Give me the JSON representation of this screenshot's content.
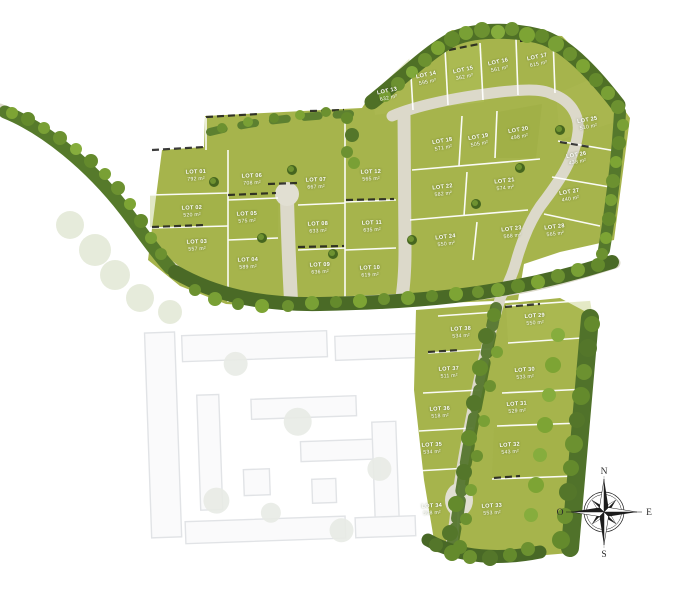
{
  "plan_title": "",
  "area_unit": "m²",
  "compass": {
    "north": "N",
    "south": "S",
    "east": "E",
    "west": "O"
  },
  "colors": {
    "lot_green": "#a6b44c",
    "tree_dark": "#47671f",
    "tree_mid": "#648a2c",
    "tree_light": "#7da434",
    "road": "#dcd9ca",
    "boundary_white": "#ffffff",
    "fence_black": "#1c1c1c",
    "ghost_gray": "#7b8591",
    "compass_ink": "#1d1d1d",
    "background": "#ffffff"
  },
  "lots": [
    {
      "id": "LOT 01",
      "area": "792 m²",
      "x": 196,
      "y": 176,
      "rot": -2
    },
    {
      "id": "LOT 02",
      "area": "520 m²",
      "x": 192,
      "y": 212,
      "rot": -2
    },
    {
      "id": "LOT 03",
      "area": "557 m²",
      "x": 197,
      "y": 246,
      "rot": -2
    },
    {
      "id": "LOT 04",
      "area": "589 m²",
      "x": 248,
      "y": 264,
      "rot": -2
    },
    {
      "id": "LOT 05",
      "area": "575 m²",
      "x": 247,
      "y": 218,
      "rot": -2
    },
    {
      "id": "LOT 06",
      "area": "708 m²",
      "x": 252,
      "y": 180,
      "rot": -2
    },
    {
      "id": "LOT 07",
      "area": "667 m²",
      "x": 316,
      "y": 184,
      "rot": -2
    },
    {
      "id": "LOT 08",
      "area": "633 m²",
      "x": 318,
      "y": 228,
      "rot": -2
    },
    {
      "id": "LOT 09",
      "area": "636 m²",
      "x": 320,
      "y": 269,
      "rot": -2
    },
    {
      "id": "LOT 10",
      "area": "619 m²",
      "x": 370,
      "y": 272,
      "rot": -2
    },
    {
      "id": "LOT 11",
      "area": "635 m²",
      "x": 372,
      "y": 227,
      "rot": -2
    },
    {
      "id": "LOT 12",
      "area": "565 m²",
      "x": 371,
      "y": 176,
      "rot": -2
    },
    {
      "id": "LOT 13",
      "area": "632 m²",
      "x": 388,
      "y": 95,
      "rot": -12
    },
    {
      "id": "LOT 14",
      "area": "595 m²",
      "x": 427,
      "y": 79,
      "rot": -12
    },
    {
      "id": "LOT 15",
      "area": "362 m²",
      "x": 464,
      "y": 74,
      "rot": -12
    },
    {
      "id": "LOT 16",
      "area": "561 m²",
      "x": 499,
      "y": 66,
      "rot": -12
    },
    {
      "id": "LOT 17",
      "area": "615 m²",
      "x": 538,
      "y": 61,
      "rot": -12
    },
    {
      "id": "LOT 18",
      "area": "571 m²",
      "x": 443,
      "y": 145,
      "rot": -10
    },
    {
      "id": "LOT 19",
      "area": "505 m²",
      "x": 479,
      "y": 141,
      "rot": -10
    },
    {
      "id": "LOT 20",
      "area": "498 m²",
      "x": 519,
      "y": 134,
      "rot": -10
    },
    {
      "id": "LOT 21",
      "area": "574 m²",
      "x": 505,
      "y": 185,
      "rot": -7
    },
    {
      "id": "LOT 22",
      "area": "582 m²",
      "x": 443,
      "y": 191,
      "rot": -7
    },
    {
      "id": "LOT 23",
      "area": "568 m²",
      "x": 512,
      "y": 233,
      "rot": -7
    },
    {
      "id": "LOT 24",
      "area": "550 m²",
      "x": 446,
      "y": 241,
      "rot": -7
    },
    {
      "id": "LOT 25",
      "area": "510 m²",
      "x": 588,
      "y": 124,
      "rot": -10
    },
    {
      "id": "LOT 26",
      "area": "438 m²",
      "x": 577,
      "y": 159,
      "rot": -10
    },
    {
      "id": "LOT 27",
      "area": "440 m²",
      "x": 570,
      "y": 196,
      "rot": -10
    },
    {
      "id": "LOT 28",
      "area": "565 m²",
      "x": 555,
      "y": 231,
      "rot": -7
    },
    {
      "id": "LOT 29",
      "area": "550 m²",
      "x": 535,
      "y": 320,
      "rot": -4
    },
    {
      "id": "LOT 30",
      "area": "533 m²",
      "x": 525,
      "y": 374,
      "rot": -4
    },
    {
      "id": "LOT 31",
      "area": "529 m²",
      "x": 517,
      "y": 408,
      "rot": -4
    },
    {
      "id": "LOT 32",
      "area": "543 m²",
      "x": 510,
      "y": 449,
      "rot": -4
    },
    {
      "id": "LOT 33",
      "area": "553 m²",
      "x": 492,
      "y": 510,
      "rot": -3
    },
    {
      "id": "LOT 34",
      "area": "508 m²",
      "x": 432,
      "y": 510,
      "rot": -3
    },
    {
      "id": "LOT 35",
      "area": "534 m²",
      "x": 432,
      "y": 449,
      "rot": -3
    },
    {
      "id": "LOT 36",
      "area": "518 m²",
      "x": 440,
      "y": 413,
      "rot": -3
    },
    {
      "id": "LOT 37",
      "area": "511 m²",
      "x": 449,
      "y": 373,
      "rot": -3
    },
    {
      "id": "LOT 38",
      "area": "534 m²",
      "x": 461,
      "y": 333,
      "rot": -3
    }
  ]
}
